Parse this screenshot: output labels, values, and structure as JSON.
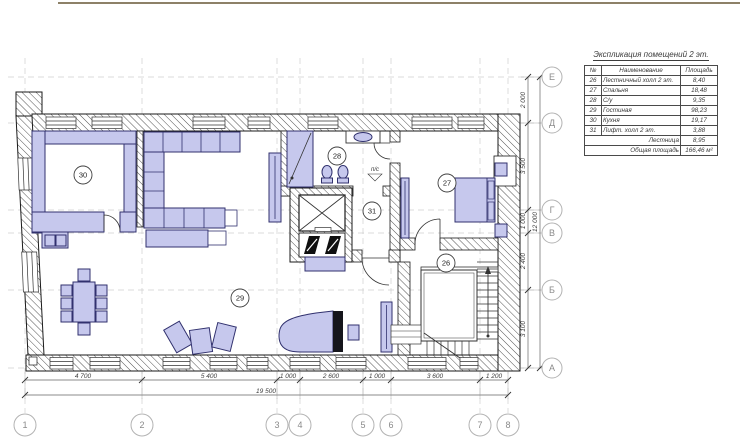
{
  "table": {
    "title": "Экспликация помещений 2 эт.",
    "headers": [
      "№",
      "Наименование",
      "Площадь"
    ],
    "rows": [
      {
        "num": "26",
        "name": "Лестничный холл 2 эт.",
        "area": "8,40"
      },
      {
        "num": "27",
        "name": "Спальня",
        "area": "18,48"
      },
      {
        "num": "28",
        "name": "С/у",
        "area": "9,35"
      },
      {
        "num": "29",
        "name": "Гостиная",
        "area": "98,23"
      },
      {
        "num": "30",
        "name": "Кухня",
        "area": "19,17"
      },
      {
        "num": "31",
        "name": "Лифт. холл 2 эт.",
        "area": "3,88"
      }
    ],
    "summary_rows": [
      {
        "label": "Лестница",
        "area": "8,95"
      },
      {
        "label": "Общая площадь",
        "area": "166,46 м²"
      }
    ]
  },
  "axes": {
    "bottom": [
      "1",
      "2",
      "3",
      "4",
      "5",
      "6",
      "7",
      "8"
    ],
    "right": [
      "Е",
      "Д",
      "Г",
      "В",
      "Б",
      "А"
    ]
  },
  "dimensions": {
    "bottom_segments": [
      "4 700",
      "5 400",
      "1 000",
      "2 600",
      "1 000",
      "3 600",
      "1 200"
    ],
    "bottom_total": "19 500",
    "right_segments": [
      "2 000",
      "3 500",
      "1 000",
      "2 400",
      "3 100"
    ],
    "right_total": "12 000"
  },
  "rooms": [
    {
      "number": "26"
    },
    {
      "number": "27"
    },
    {
      "number": "28"
    },
    {
      "number": "29"
    },
    {
      "number": "30"
    },
    {
      "number": "31"
    }
  ],
  "labels": {
    "ps": "п/с"
  },
  "colors": {
    "furniture_fill": "#c6c8ed",
    "furniture_stroke": "#31316e",
    "wall_line": "#1a1a1a",
    "dimension_text": "#3c3c3c",
    "grid_line": "#cfcfcf",
    "top_border_line": "#8d8168"
  }
}
